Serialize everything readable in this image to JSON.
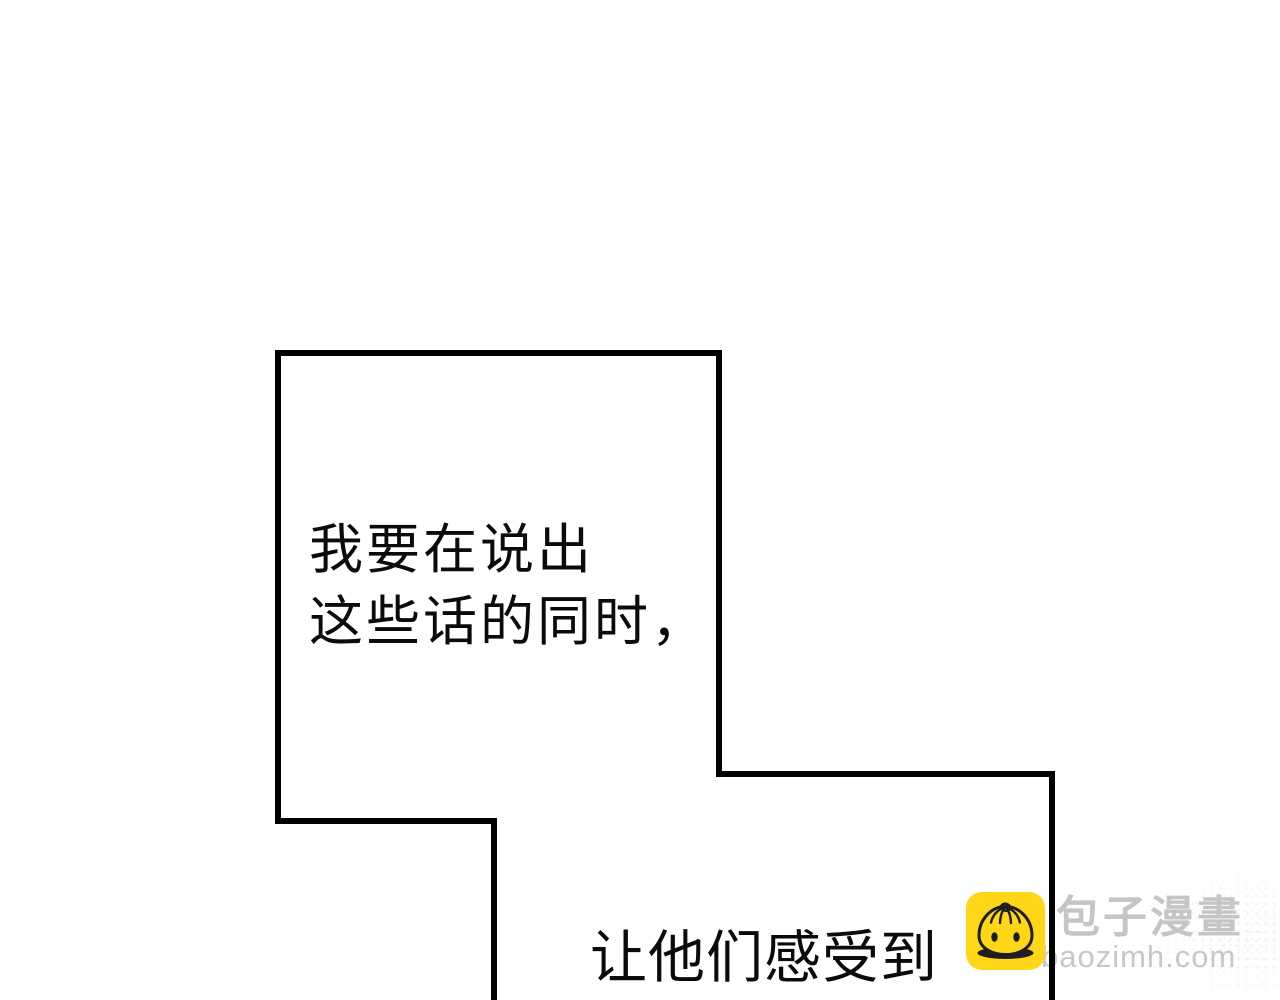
{
  "page": {
    "background_color": "#ffffff",
    "width": 1280,
    "height": 1000
  },
  "panel": {
    "shape": "staircase-panel-border",
    "border_color": "#000000",
    "border_width_px": 6
  },
  "dialogue": {
    "bubble1": {
      "line1": "我要在说出",
      "line2": "这些话的同时，"
    },
    "bubble2": {
      "line1": "让他们感受到"
    }
  },
  "watermark": {
    "site_name": "包子漫畫",
    "site_url": "baozimh.com",
    "icon": "baozi-bun-icon",
    "icon_bg_color": "#ffd717",
    "icon_line_color": "#1e1e1e",
    "name_color": "#c5c5c5",
    "url_color": "#c7c7c7"
  }
}
